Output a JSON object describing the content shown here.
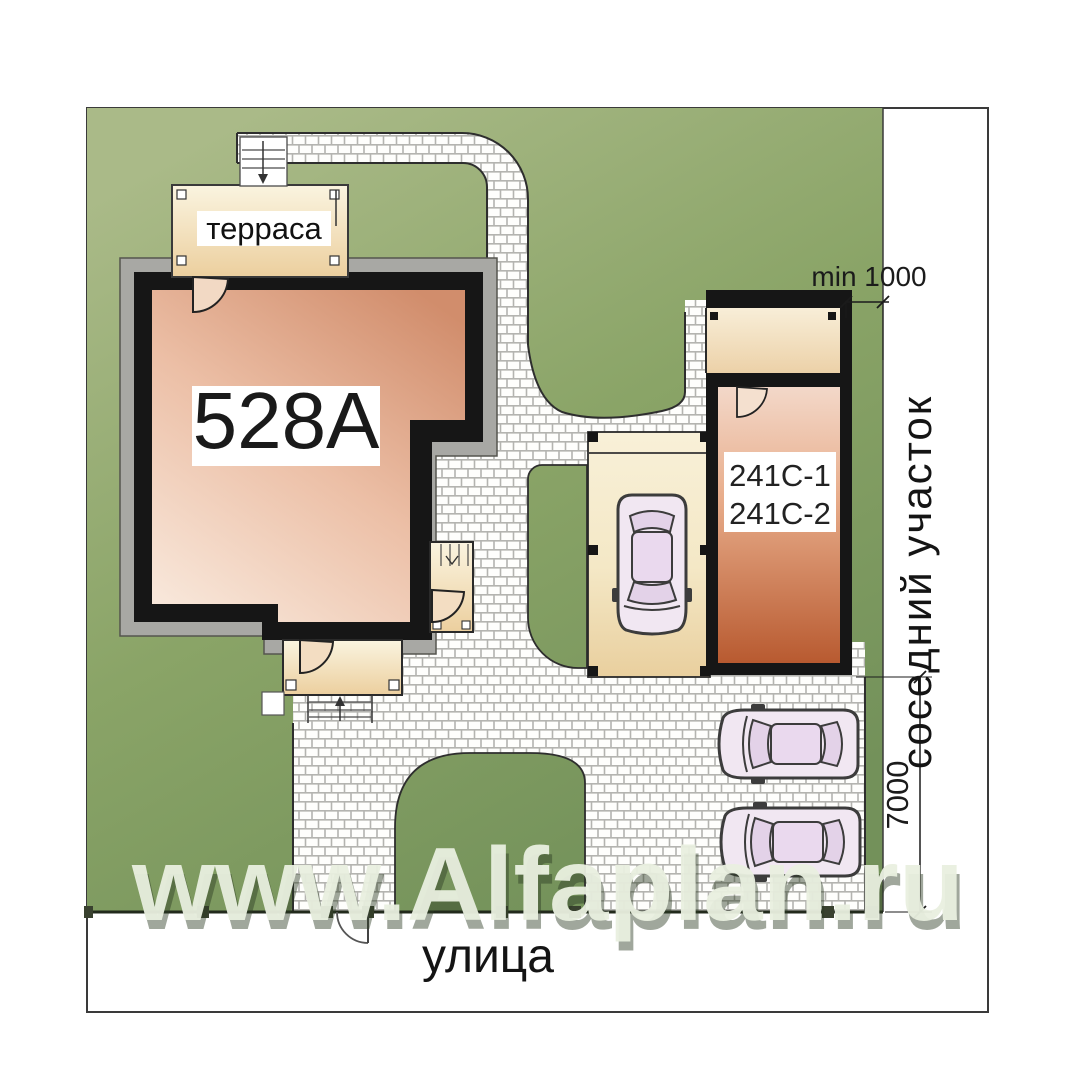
{
  "labels": {
    "watermark": "www.Alfaplan.ru",
    "street": "улица",
    "neighbor_plot": "соседний участок",
    "terrace": "терраса",
    "house_number": "528A",
    "garage_model_1": "241C-1",
    "garage_model_2": "241C-2",
    "setback_dim": "min 1000",
    "frontage_dim": "7000"
  },
  "colors": {
    "plot_green": "#8aa467",
    "paving_mortar": "#b4b4b0",
    "wall_black": "#161616",
    "house_interior": "#ecbfa6",
    "terrace_cream": "#f2dfb8",
    "garage_terracotta": "#b85a30",
    "eave_gray": "#a8a8a4",
    "watermark_green": "#e9efdf"
  }
}
